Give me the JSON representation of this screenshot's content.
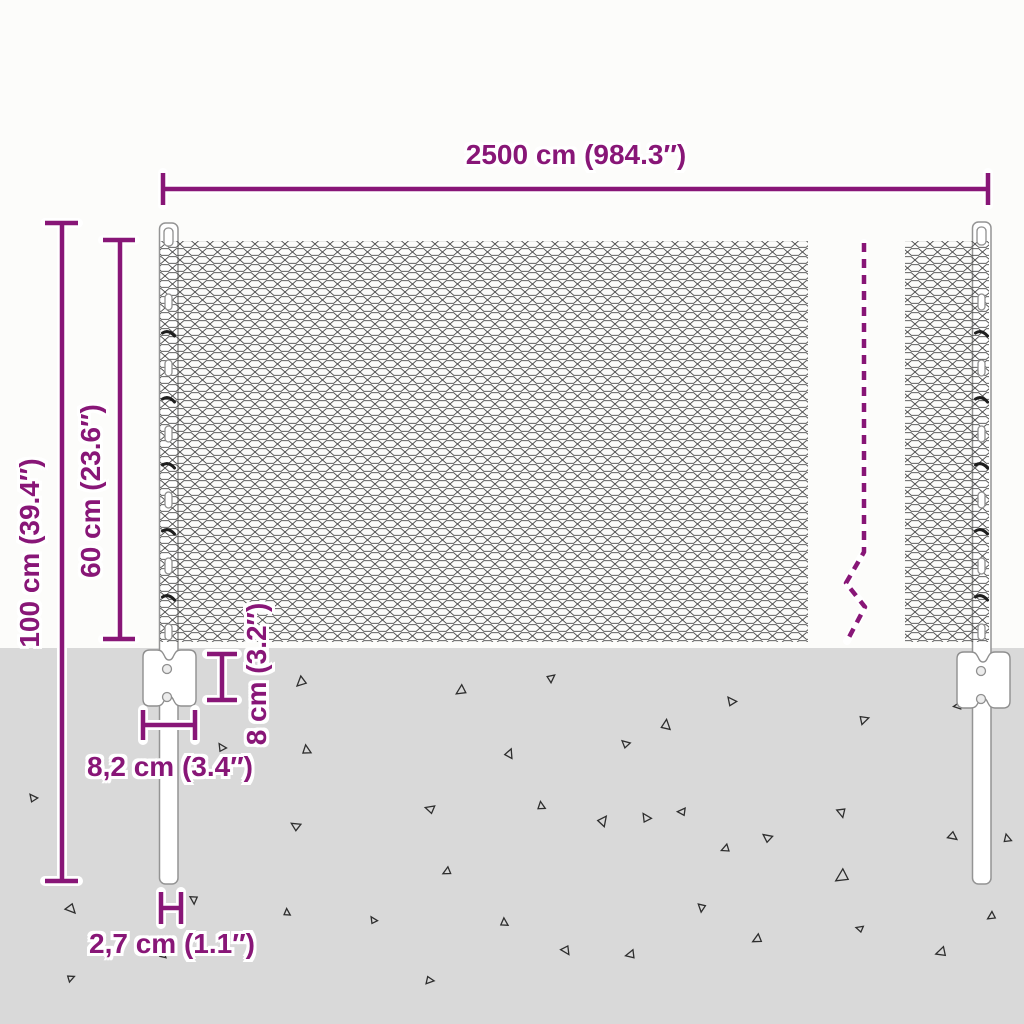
{
  "image_type": "product-dimension-diagram",
  "product": "chain-link wire mesh fence with posts and anchor plates",
  "colors": {
    "accent": "#881677",
    "background": "#fcfcfa",
    "ground": "#d9d9d9",
    "mesh_wire": "#4a4a4a",
    "post_outline": "#949494",
    "triangle": "#2e2e2e"
  },
  "labels": {
    "total_width": "2500 cm (984.3″)",
    "total_height": "100 cm (39.4″)",
    "mesh_height": "60 cm (23.6″)",
    "anchor_plate_height": "8 cm (3.2″)",
    "anchor_plate_width": "8,2 cm (3.4″)",
    "post_diameter": "2,7 cm (1.1″)"
  },
  "ground": {
    "triangles": [
      [
        297,
        676,
        10,
        0
      ],
      [
        458,
        684,
        10,
        10
      ],
      [
        554,
        683,
        8,
        185
      ],
      [
        737,
        698,
        9,
        95
      ],
      [
        227,
        745,
        8,
        100
      ],
      [
        313,
        750,
        9,
        125
      ],
      [
        515,
        757,
        9,
        155
      ],
      [
        630,
        740,
        8,
        85
      ],
      [
        673,
        727,
        10,
        140
      ],
      [
        865,
        726,
        9,
        205
      ],
      [
        958,
        700,
        8,
        35
      ],
      [
        38,
        795,
        8,
        95
      ],
      [
        300,
        821,
        9,
        75
      ],
      [
        433,
        803,
        9,
        60
      ],
      [
        547,
        806,
        8,
        125
      ],
      [
        608,
        826,
        10,
        170
      ],
      [
        652,
        815,
        9,
        100
      ],
      [
        683,
        806,
        8,
        45
      ],
      [
        724,
        843,
        8,
        20
      ],
      [
        772,
        833,
        9,
        80
      ],
      [
        835,
        813,
        9,
        300
      ],
      [
        838,
        868,
        13,
        10
      ],
      [
        948,
        841,
        9,
        260
      ],
      [
        445,
        866,
        8,
        15
      ],
      [
        65,
        913,
        10,
        270
      ],
      [
        188,
        899,
        8,
        310
      ],
      [
        292,
        913,
        7,
        130
      ],
      [
        378,
        918,
        7,
        100
      ],
      [
        510,
        923,
        8,
        130
      ],
      [
        560,
        953,
        9,
        280
      ],
      [
        630,
        948,
        9,
        30
      ],
      [
        696,
        906,
        8,
        320
      ],
      [
        755,
        933,
        9,
        15
      ],
      [
        862,
        924,
        7,
        60
      ],
      [
        940,
        945,
        10,
        25
      ],
      [
        989,
        911,
        8,
        10
      ],
      [
        72,
        983,
        7,
        200
      ],
      [
        168,
        956,
        7,
        140
      ],
      [
        428,
        986,
        8,
        230
      ],
      [
        1013,
        838,
        8,
        120
      ]
    ]
  }
}
